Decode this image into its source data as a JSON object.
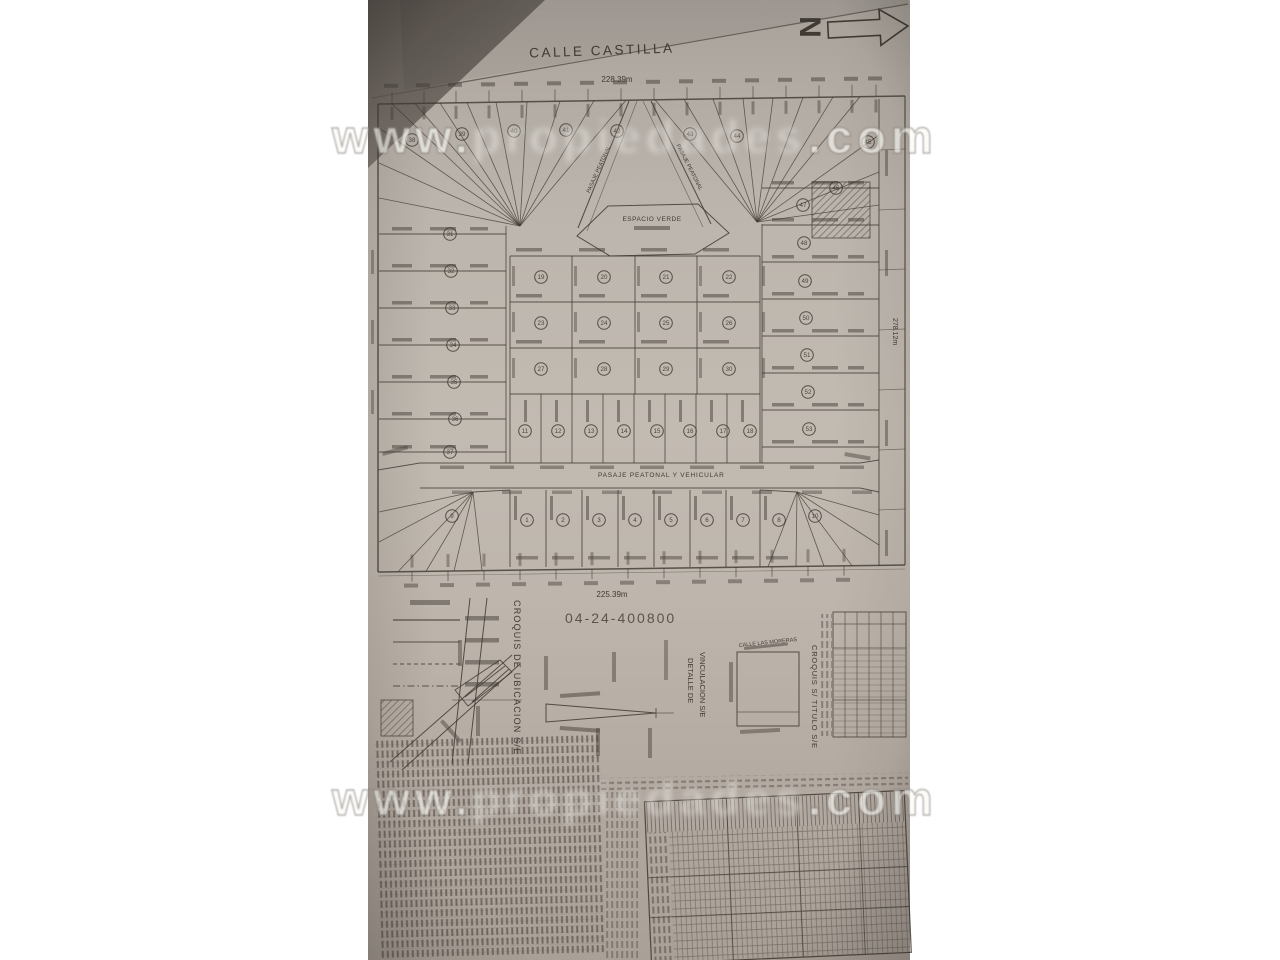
{
  "colors": {
    "paper": "#bcb5ac",
    "paper_shadow": "#5f5953",
    "ink": "#3f3933",
    "watermark": "#f5f2ee"
  },
  "plan": {
    "street_top": "CALLE CASTILLA",
    "north_letter": "N",
    "dim_top": "228.39m",
    "dim_bottom": "225.39m",
    "dim_right": "278.12m",
    "file_number": "04-24-400800",
    "green_space": "ESPACIO VERDE",
    "passage_main": "PASAJE PEATONAL Y VEHICULAR",
    "passage_upper_left": "PASAJE PEATONAL",
    "passage_upper_right": "PASAJE PEATONAL",
    "croquis_ubicacion": "CROQUIS DE UBICACION S/E",
    "detalle_line1": "DETALLE DE",
    "detalle_line2": "VINCULACION S/E",
    "croquis_titulo": "CROQUIS S/ TITULO S/E",
    "street_side": "CALLE LAS MORERAS",
    "watermark_prefix": "www.",
    "watermark_middle": "propiedades",
    "watermark_suffix": ".com",
    "lots": [
      {
        "n": "1",
        "x": 527,
        "y": 520
      },
      {
        "n": "2",
        "x": 563,
        "y": 520
      },
      {
        "n": "3",
        "x": 599,
        "y": 520
      },
      {
        "n": "4",
        "x": 635,
        "y": 520
      },
      {
        "n": "5",
        "x": 671,
        "y": 520
      },
      {
        "n": "6",
        "x": 707,
        "y": 520
      },
      {
        "n": "7",
        "x": 743,
        "y": 520
      },
      {
        "n": "8",
        "x": 779,
        "y": 520
      },
      {
        "n": "9",
        "x": 452,
        "y": 516
      },
      {
        "n": "10",
        "x": 815,
        "y": 516
      },
      {
        "n": "11",
        "x": 525,
        "y": 431
      },
      {
        "n": "12",
        "x": 558,
        "y": 431
      },
      {
        "n": "13",
        "x": 591,
        "y": 431
      },
      {
        "n": "14",
        "x": 624,
        "y": 431
      },
      {
        "n": "15",
        "x": 657,
        "y": 431
      },
      {
        "n": "16",
        "x": 690,
        "y": 431
      },
      {
        "n": "17",
        "x": 723,
        "y": 431
      },
      {
        "n": "18",
        "x": 750,
        "y": 431
      },
      {
        "n": "19",
        "x": 541,
        "y": 277
      },
      {
        "n": "20",
        "x": 604,
        "y": 277
      },
      {
        "n": "21",
        "x": 666,
        "y": 277
      },
      {
        "n": "22",
        "x": 729,
        "y": 277
      },
      {
        "n": "23",
        "x": 541,
        "y": 323
      },
      {
        "n": "24",
        "x": 604,
        "y": 323
      },
      {
        "n": "25",
        "x": 666,
        "y": 323
      },
      {
        "n": "26",
        "x": 729,
        "y": 323
      },
      {
        "n": "27",
        "x": 541,
        "y": 369
      },
      {
        "n": "28",
        "x": 604,
        "y": 369
      },
      {
        "n": "29",
        "x": 666,
        "y": 369
      },
      {
        "n": "30",
        "x": 729,
        "y": 369
      },
      {
        "n": "31",
        "x": 450,
        "y": 234
      },
      {
        "n": "32",
        "x": 451,
        "y": 271
      },
      {
        "n": "33",
        "x": 452,
        "y": 308
      },
      {
        "n": "34",
        "x": 453,
        "y": 345
      },
      {
        "n": "35",
        "x": 454,
        "y": 382
      },
      {
        "n": "36",
        "x": 455,
        "y": 419
      },
      {
        "n": "37",
        "x": 450,
        "y": 452
      },
      {
        "n": "38",
        "x": 412,
        "y": 140
      },
      {
        "n": "39",
        "x": 462,
        "y": 134
      },
      {
        "n": "40",
        "x": 514,
        "y": 131
      },
      {
        "n": "41",
        "x": 566,
        "y": 130
      },
      {
        "n": "42",
        "x": 617,
        "y": 131
      },
      {
        "n": "43",
        "x": 690,
        "y": 134
      },
      {
        "n": "44",
        "x": 737,
        "y": 136
      },
      {
        "n": "45",
        "x": 868,
        "y": 142
      },
      {
        "n": "46",
        "x": 836,
        "y": 188
      },
      {
        "n": "47",
        "x": 803,
        "y": 205
      },
      {
        "n": "48",
        "x": 804,
        "y": 243
      },
      {
        "n": "49",
        "x": 805,
        "y": 281
      },
      {
        "n": "50",
        "x": 806,
        "y": 318
      },
      {
        "n": "51",
        "x": 807,
        "y": 355
      },
      {
        "n": "52",
        "x": 808,
        "y": 392
      },
      {
        "n": "53",
        "x": 809,
        "y": 429
      }
    ]
  }
}
